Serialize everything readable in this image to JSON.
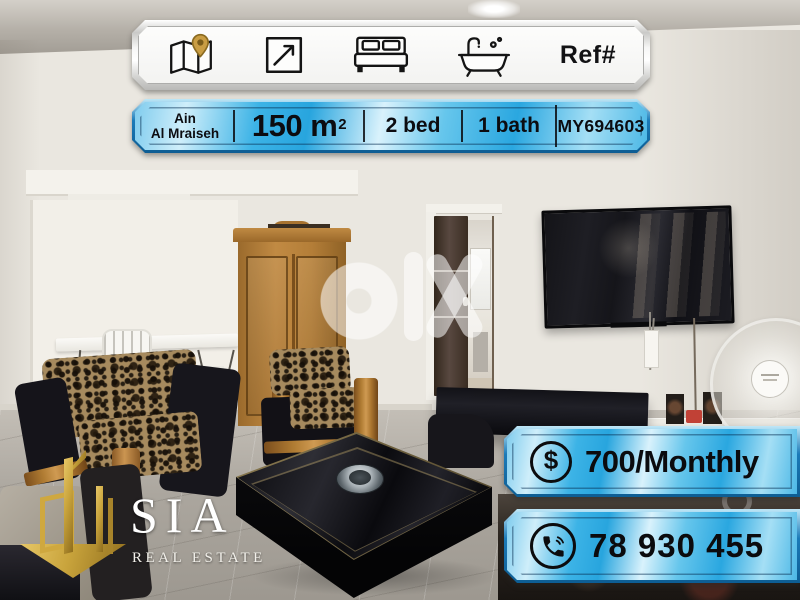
{
  "watermark": {
    "brand": "olx"
  },
  "features_banner": {
    "ref_label": "Ref#",
    "icons": [
      {
        "name": "map-location-icon",
        "meaning": "location"
      },
      {
        "name": "dimensions-icon",
        "meaning": "area"
      },
      {
        "name": "bed-icon",
        "meaning": "bedrooms"
      },
      {
        "name": "bathtub-icon",
        "meaning": "bathrooms"
      }
    ]
  },
  "details_banner": {
    "location_line1": "Ain",
    "location_line2": "Al Mraiseh",
    "area_value": "150 m",
    "area_exponent": "2",
    "bedrooms": "2 bed",
    "bathrooms": "1 bath",
    "reference_code": "MY694603"
  },
  "price_banner": {
    "currency_symbol": "$",
    "amount": "700/Monthly"
  },
  "phone_banner": {
    "number": "78 930 455"
  },
  "agency": {
    "name": "SIA",
    "tagline": "REAL ESTATE"
  },
  "colors": {
    "plaque_blue": "#2fade2",
    "plaque_blue_dark": "#1173ae",
    "plaque_silver": "#e8e8e6",
    "gold": "#c9a43c",
    "text": "#0d0d10"
  }
}
